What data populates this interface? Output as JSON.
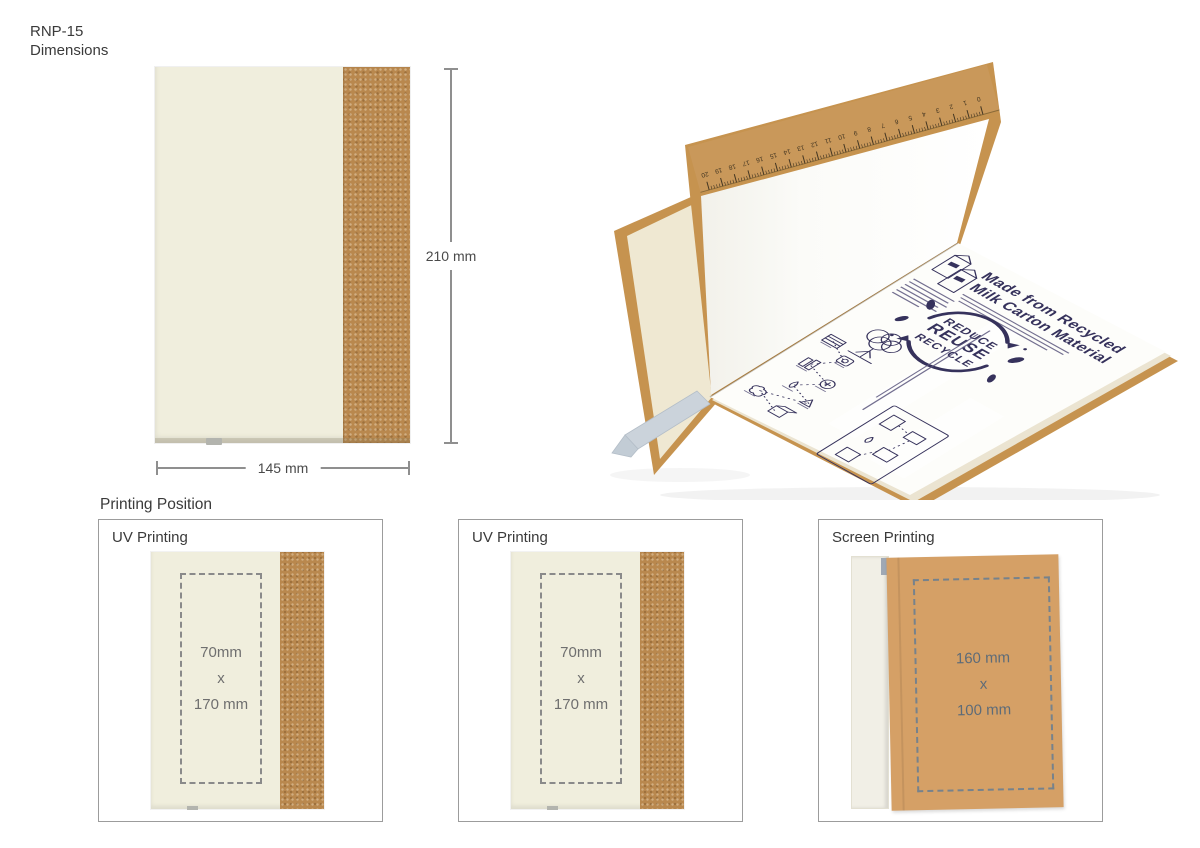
{
  "page": {
    "title_line1": "RNP-15",
    "title_line2": "Dimensions"
  },
  "dimensions_figure": {
    "height_label": "210 mm",
    "width_label": "145 mm"
  },
  "photo": {
    "ruler_numbers": [
      20,
      19,
      18,
      17,
      16,
      15,
      14,
      13,
      12,
      11,
      10,
      9,
      8,
      7,
      6,
      5,
      4,
      3,
      2,
      1,
      0
    ],
    "print": {
      "title_line1": "Made from Recycled",
      "title_line2": "Milk Carton Material",
      "badge_words": [
        "REDUCE",
        "REUSE",
        "RECYCLE"
      ]
    }
  },
  "printing": {
    "heading": "Printing Position",
    "boxes": [
      {
        "label": "UV Printing",
        "size_lines": [
          "70mm",
          "x",
          "170 mm"
        ]
      },
      {
        "label": "UV Printing",
        "size_lines": [
          "70mm",
          "x",
          "170 mm"
        ]
      },
      {
        "label": "Screen Printing",
        "size_lines": [
          "160 mm",
          "x",
          "100 mm"
        ]
      }
    ]
  },
  "colors": {
    "cream": "#f0eedd",
    "cork": "#b9884e",
    "kraft": "#c6934f",
    "kraft-light": "#c9985a",
    "brown-page": "#d5a066",
    "navy": "#36325c",
    "ribbon": "#cbd3db",
    "box-border": "#9c9c9c",
    "dash-grey": "#8a8a8a",
    "dash-blue": "#76828c",
    "dim-grey": "#8f8f8f",
    "text-dark": "#3a3a3a",
    "size-grey": "#6f6f6f",
    "size-blue": "#5d6b78",
    "page-white": "#fdfdfa",
    "ruler-ink": "#443622"
  }
}
